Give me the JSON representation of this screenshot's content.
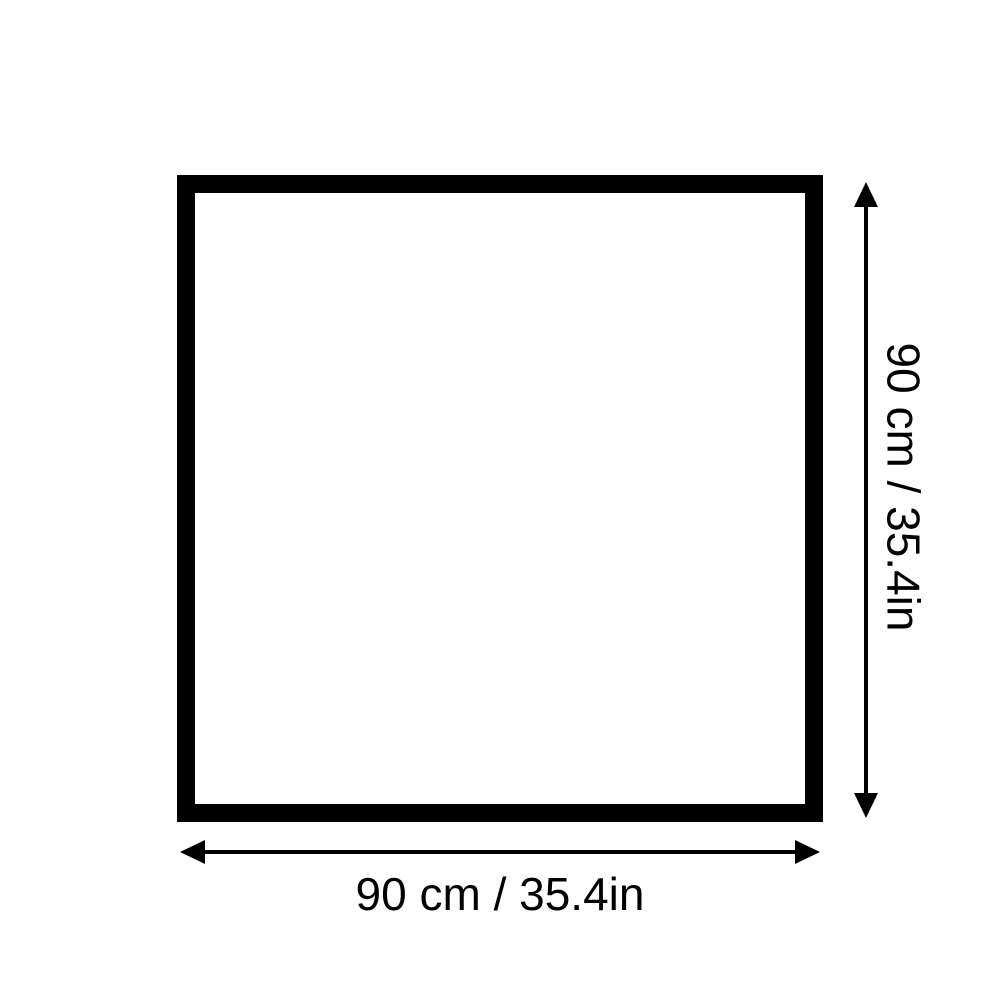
{
  "diagram": {
    "shape": "square",
    "width": {
      "cm": 90,
      "inches": 35.4,
      "label": "90 cm / 35.4in"
    },
    "height": {
      "cm": 90,
      "inches": 35.4,
      "label": "90 cm / 35.4in"
    },
    "colors": {
      "line": "#000000",
      "text": "#000000",
      "background": "#ffffff"
    }
  }
}
